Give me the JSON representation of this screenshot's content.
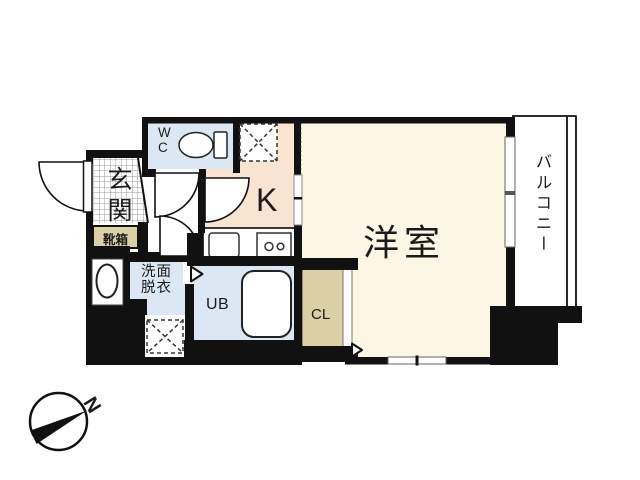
{
  "floorplan": {
    "rooms": {
      "wc": "WC",
      "entrance": "玄関",
      "shoe_box": "靴箱",
      "kitchen": "K",
      "washroom": "洗面脱衣",
      "unit_bath": "UB",
      "closet": "CL",
      "western_room": "洋室",
      "balcony": "バルコニー"
    },
    "compass_north": "N",
    "colors": {
      "wall": "#111111",
      "western_room_floor": "#fbf7e4",
      "kitchen_floor": "#f9e3d1",
      "wet_room_floor": "#dbe8f3",
      "storage_fill": "#dbcfa5",
      "tile_line": "#9a9a9a"
    },
    "icons": [
      "toilet-icon",
      "bathtub-icon",
      "kitchen-sink-icon",
      "stove-icon",
      "washbasin-icon",
      "door-swing-icon",
      "entry-arrow-icon",
      "window-icon",
      "sliding-door-icon",
      "fridge-space-icon",
      "washer-space-icon",
      "compass-icon"
    ]
  }
}
